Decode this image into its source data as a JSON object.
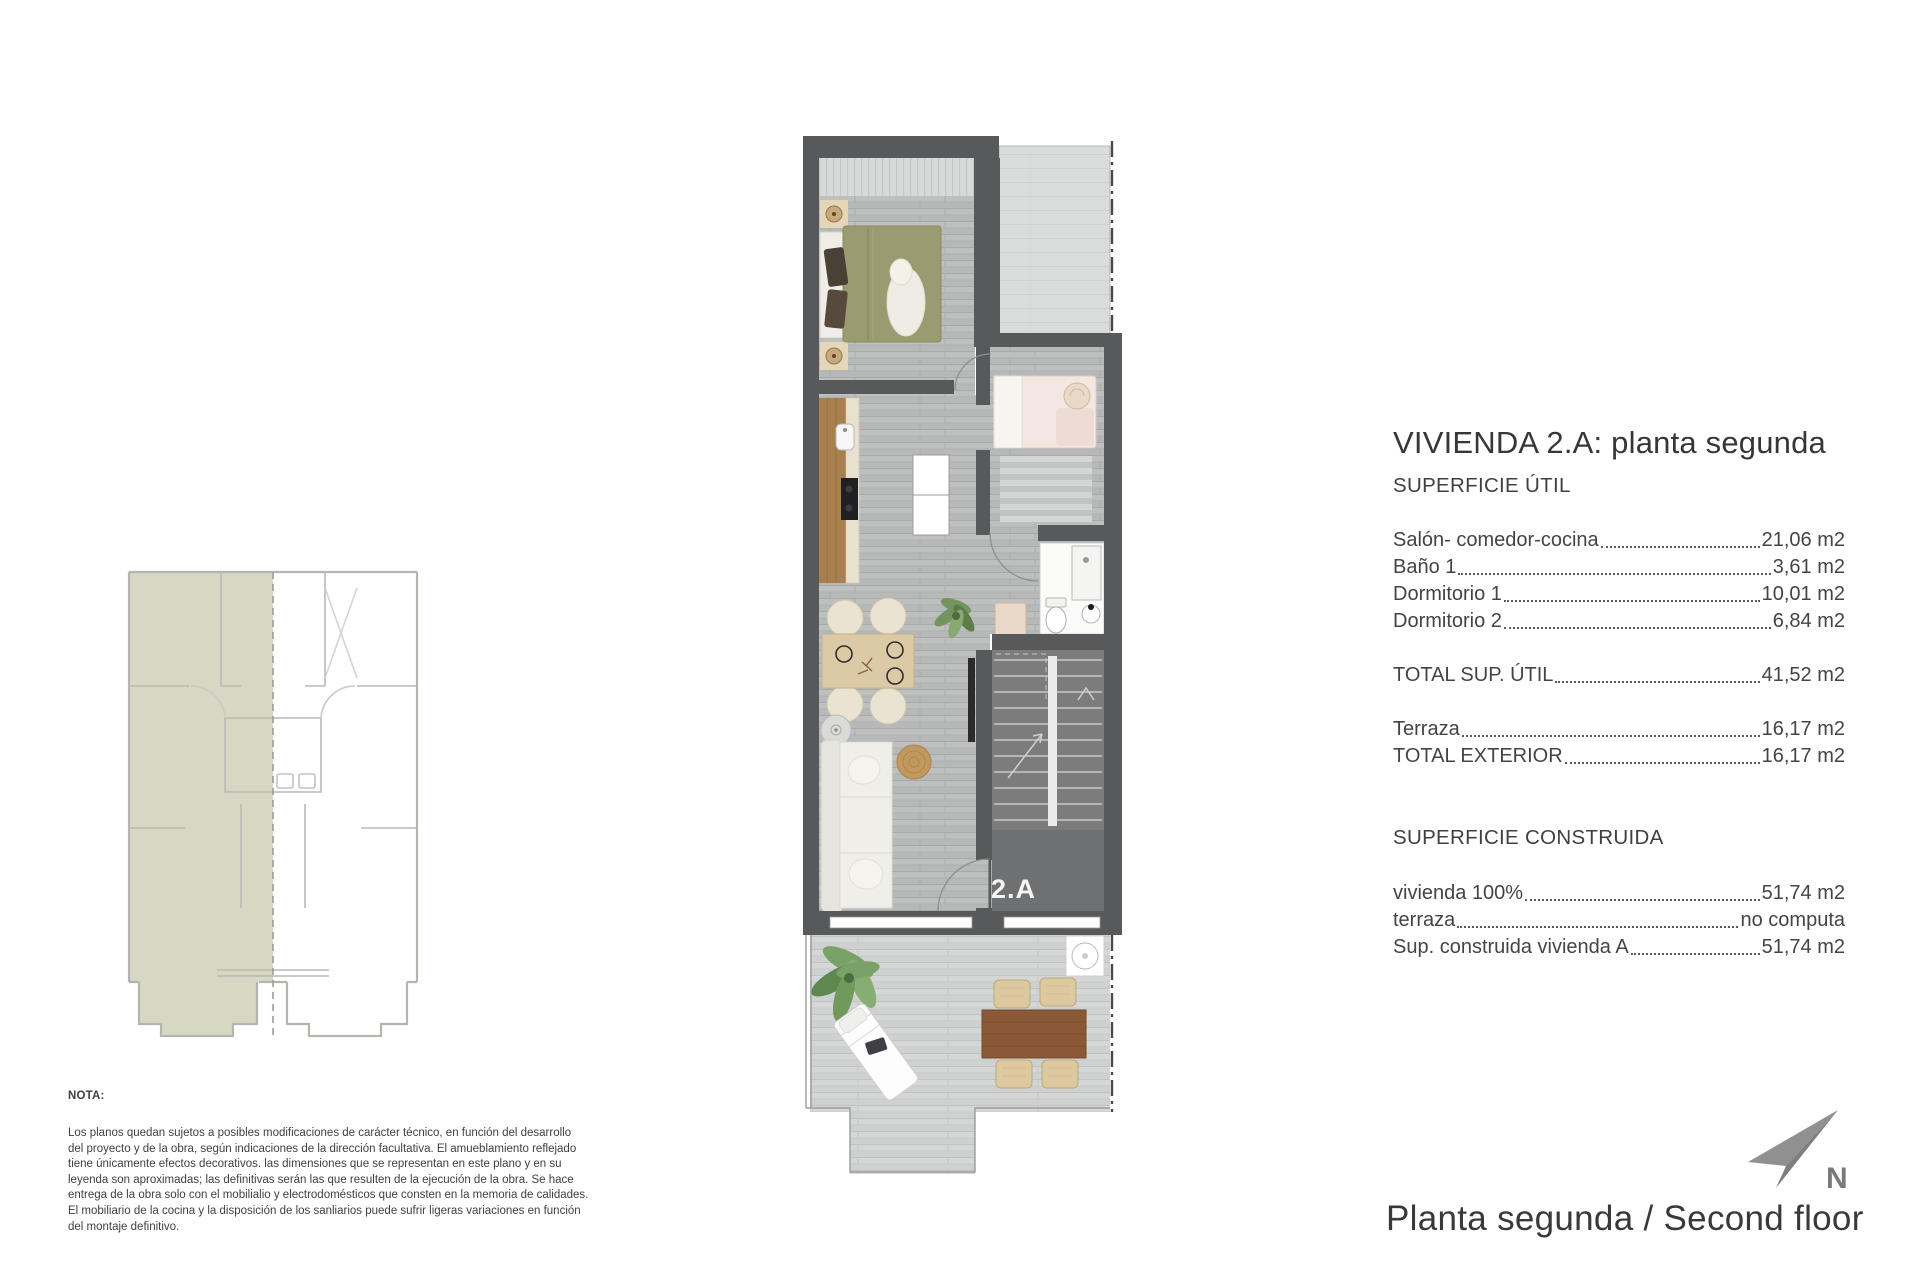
{
  "header": {
    "title": "VIVIENDA 2.A: planta segunda"
  },
  "surface_table": {
    "section1_header": "SUPERFICIE ÚTIL",
    "rows_util": [
      {
        "label": "Salón- comedor-cocina",
        "value": "21,06 m2"
      },
      {
        "label": "Baño 1",
        "value": "3,61 m2"
      },
      {
        "label": "Dormitorio 1",
        "value": "10,01 m2"
      },
      {
        "label": "Dormitorio 2",
        "value": "6,84 m2"
      }
    ],
    "row_total_util": {
      "label": "TOTAL SUP. ÚTIL",
      "value": "41,52 m2"
    },
    "rows_exterior": [
      {
        "label": "Terraza",
        "value": "16,17 m2"
      },
      {
        "label": "TOTAL EXTERIOR",
        "value": "16,17 m2"
      }
    ],
    "section2_header": "SUPERFICIE CONSTRUIDA",
    "rows_construida": [
      {
        "label": "vivienda 100%",
        "value": "51,74 m2"
      },
      {
        "label": "terraza",
        "value": "no computa"
      },
      {
        "label": "Sup. construida vivienda A",
        "value": "51,74 m2"
      }
    ]
  },
  "plan": {
    "unit_label": "2.A"
  },
  "compass": {
    "north_label": "N"
  },
  "footer": {
    "caption": "Planta segunda / Second floor"
  },
  "nota": {
    "heading": "NOTA:",
    "body": "Los planos quedan sujetos a posibles modificaciones de carácter técnico, en función del desarrollo\ndel proyecto y de la obra, según indicaciones de la dirección facultativa. El amueblamiento reflejado\ntiene únicamente efectos decorativos. las dimensiones que se representan en este plano y en su\nleyenda son aproximadas; las definitivas serán las que resulten de la ejecución de la obra. Se hace\nentrega de la obra solo con el mobilialio y electrodomésticos que consten en la memoria de calidades.\nEl mobiliario de la cocina y la disposición de los sanliarios puede sufrir ligeras variaciones en función\ndel montaje definitivo."
  },
  "colors": {
    "wall_gray": "#58595a",
    "keyplan_highlight_green": "#d6d8c3",
    "stair_gray": "#7c7c7d",
    "floor_gray": "#b6b9b8",
    "terrace_gray": "#ced1d0",
    "kitchen_wood": "#a87f4e",
    "compass_gray": "#8d8d8d"
  }
}
